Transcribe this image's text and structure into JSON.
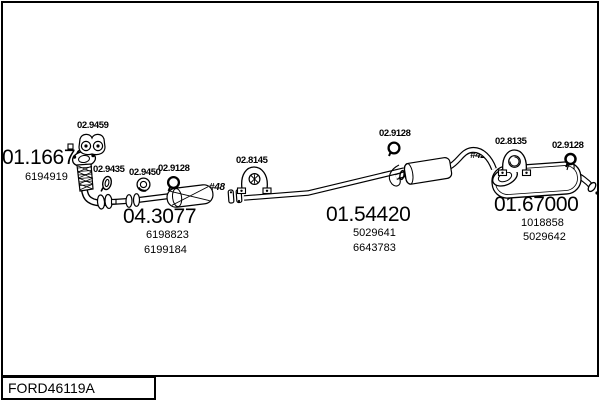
{
  "colors": {
    "ink": "#000000",
    "background": "#ffffff"
  },
  "footer": {
    "code": "FORD46119A"
  },
  "parts": [
    {
      "name": "front-pipe",
      "code": "01.16670",
      "refs": [
        "6194919"
      ]
    },
    {
      "name": "catalytic-converter",
      "code": "04.3077",
      "refs": [
        "6198823",
        "6199184"
      ]
    },
    {
      "name": "centre-silencer",
      "code": "01.54420",
      "refs": [
        "5029641",
        "6643783"
      ]
    },
    {
      "name": "rear-silencer",
      "code": "01.67000",
      "refs": [
        "1018858",
        "5029642"
      ]
    }
  ],
  "fittings": [
    {
      "code": "02.9459",
      "icon": "rubber-mount-icon"
    },
    {
      "code": "02.9435",
      "icon": "pipe-clamp-icon"
    },
    {
      "code": "02.9450",
      "icon": "ring-gasket-icon"
    },
    {
      "code": "02.9128",
      "icon": "round-clamp-icon"
    },
    {
      "code": "02.8145",
      "icon": "rubber-hanger-icon"
    },
    {
      "code": "02.9128",
      "icon": "round-clamp-icon"
    },
    {
      "code": "02.8135",
      "icon": "rubber-hanger-icon"
    },
    {
      "code": "02.9128",
      "icon": "round-clamp-icon"
    }
  ],
  "annotations": [
    {
      "label": "#48"
    },
    {
      "label": "#42"
    }
  ]
}
